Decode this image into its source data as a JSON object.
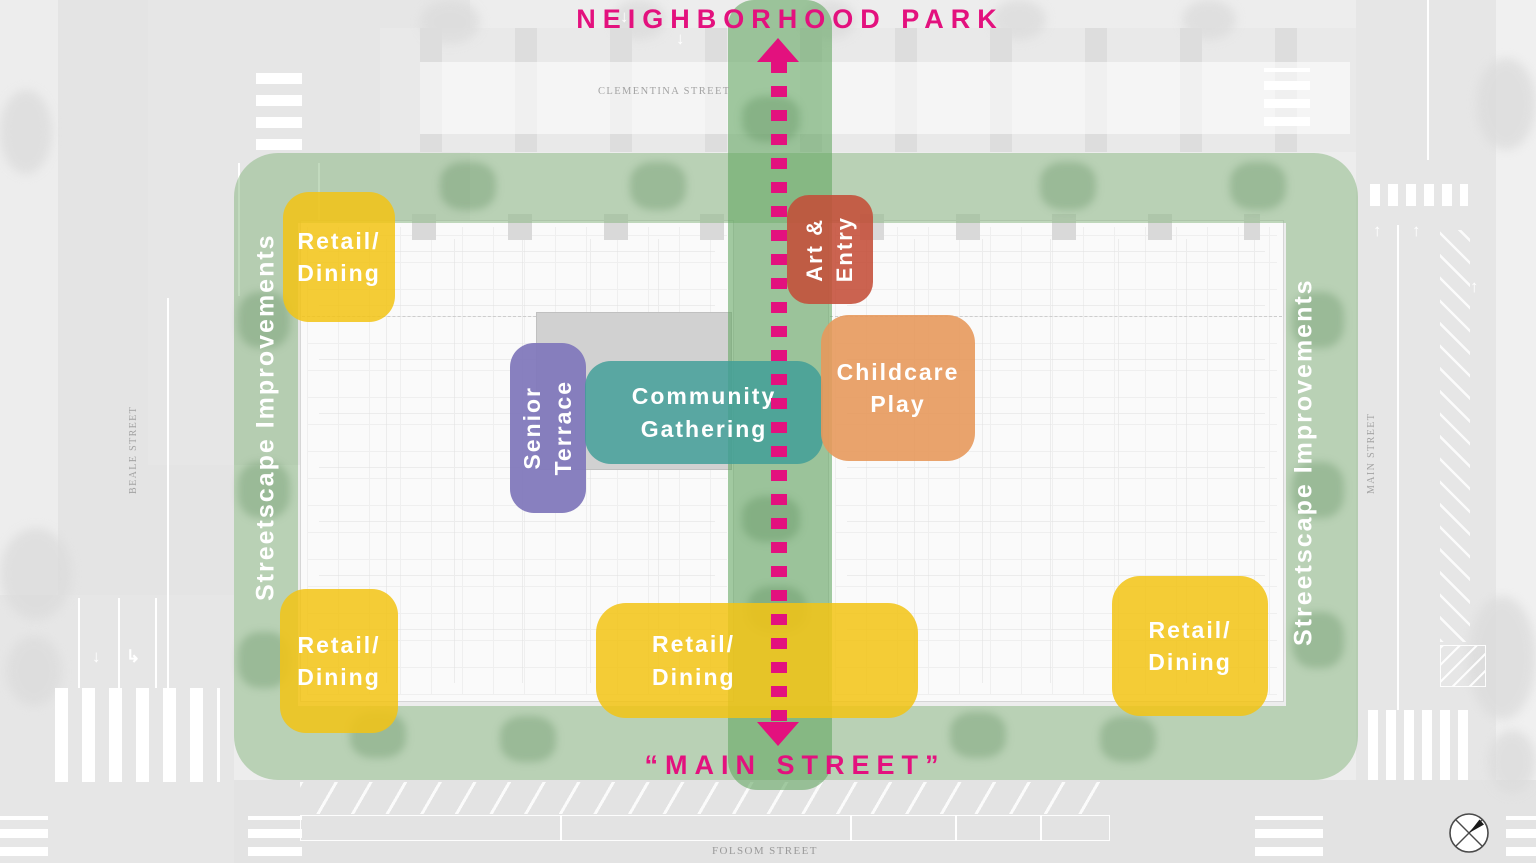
{
  "titles": {
    "park": "NEIGHBORHOOD PARK",
    "main_street": "“MAIN STREET”"
  },
  "overlay_labels": {
    "streetscape_left": "Streetscape Improvements",
    "streetscape_right": "Streetscape Improvements"
  },
  "zones": {
    "retail_top_left": {
      "line1": "Retail/",
      "line2": "Dining"
    },
    "retail_bottom_left": {
      "line1": "Retail/",
      "line2": "Dining"
    },
    "retail_bottom_center": {
      "line1": "Retail/",
      "line2": "Dining"
    },
    "retail_bottom_right": {
      "line1": "Retail/",
      "line2": "Dining"
    },
    "senior_terrace": {
      "line1": "Senior",
      "line2": "Terrace"
    },
    "community_gathering": {
      "line1": "Community",
      "line2": "Gathering"
    },
    "childcare_play": {
      "line1": "Childcare",
      "line2": "Play"
    },
    "art_entry": {
      "line1": "Art &",
      "line2": "Entry"
    }
  },
  "street_labels": {
    "clementina": "CLEMENTINA STREET",
    "beale": "BEALE STREET",
    "main": "MAIN STREET",
    "folsom": "FOLSOM STREET"
  },
  "colors": {
    "magenta": "#e3117e",
    "streetscape_green": "#82b27a",
    "spine_green": "#61a65e",
    "retail_yellow": "#f2c415",
    "senior_purple": "#8279bc",
    "community_teal": "#3f9e98",
    "childcare_orange": "#e7995c",
    "art_red": "#c44d38"
  },
  "icons": {
    "north_arrow": "north-arrow"
  }
}
